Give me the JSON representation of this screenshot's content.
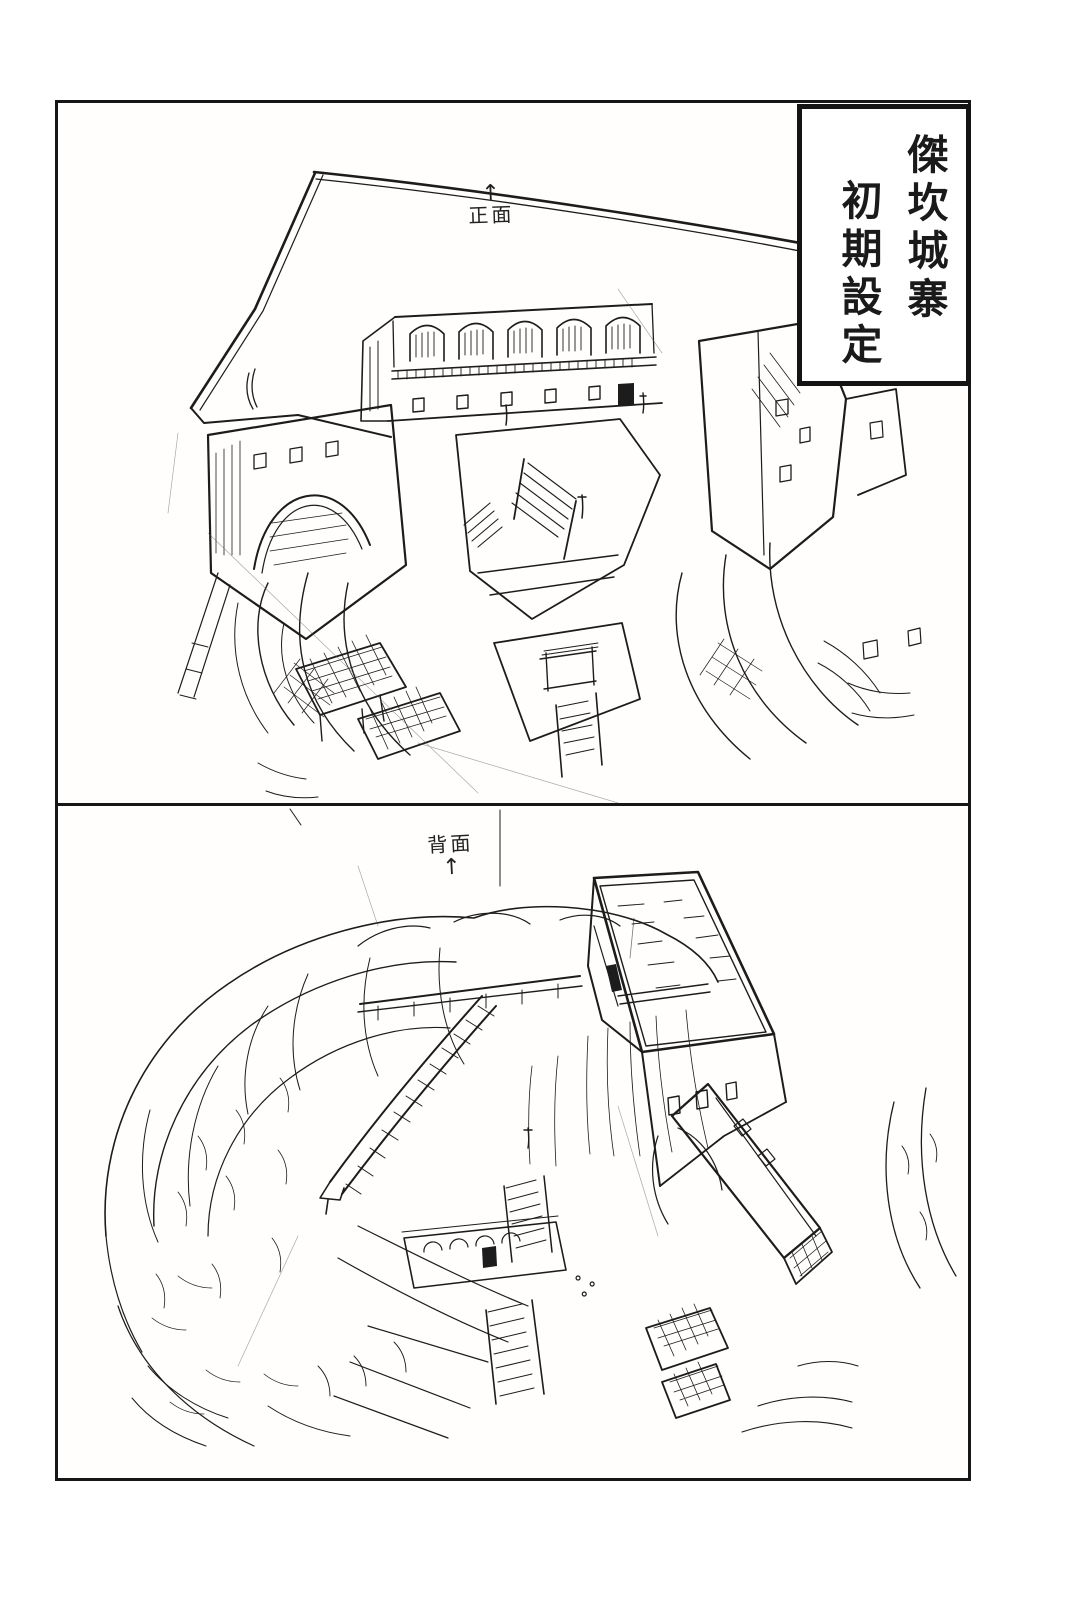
{
  "page": {
    "paper_color": "#ffffff",
    "ink_color": "#1c1c1c"
  },
  "title_box": {
    "column_right": "傑坎城寨",
    "column_left": "初期設定",
    "full_title": "傑坎城寨 初期設定"
  },
  "panels": [
    {
      "view": "front",
      "direction_arrow": "↑",
      "label": "正面"
    },
    {
      "view": "back",
      "direction_arrow": "↑",
      "label": "背面"
    }
  ]
}
